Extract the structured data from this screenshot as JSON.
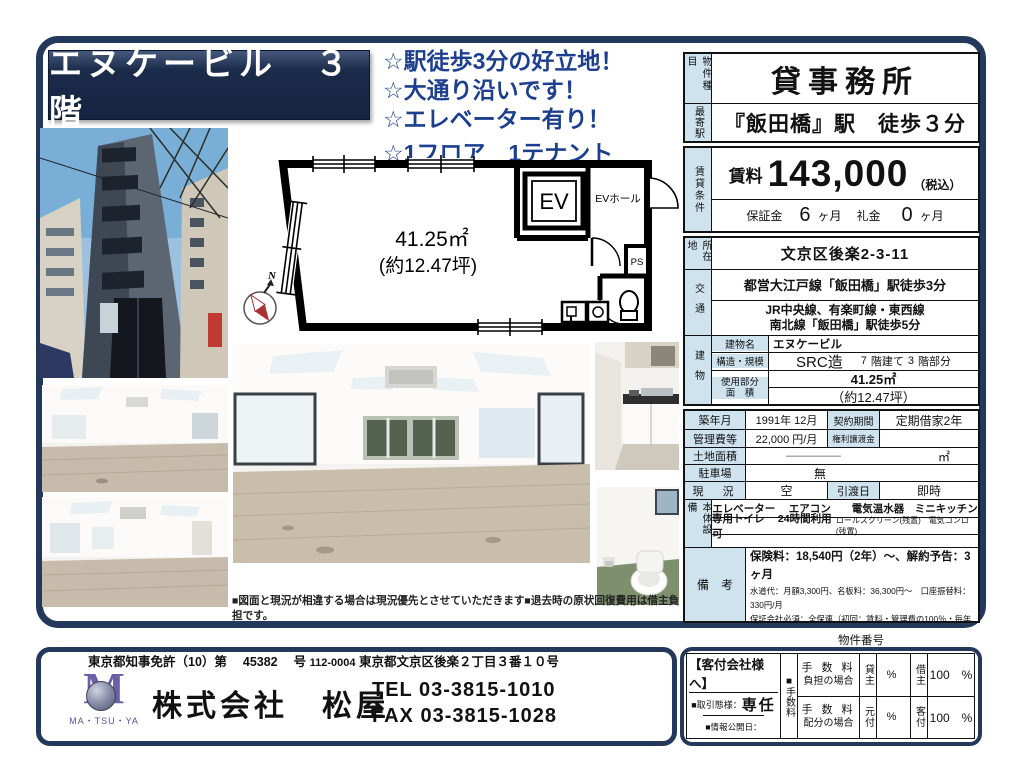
{
  "header": {
    "title": "エヌケービル　３階",
    "highlights": [
      "☆駅徒歩3分の好立地！",
      "☆大通り沿いです！",
      "☆エレベーター有り！",
      "☆1フロア　1テナント"
    ]
  },
  "floorplan": {
    "area": "41.25㎡",
    "tsubo": "(約12.47坪)",
    "ev": "EV",
    "ev_hall": "EVホール",
    "ps": "PS",
    "north": "N"
  },
  "spec": {
    "type_h": "物件種目",
    "type": "貸事務所",
    "station_h": "最寄駅",
    "station": "『飯田橋』駅　徒歩３分",
    "terms_h": "賃貸条件",
    "rent_label": "賃料",
    "rent": "143,000",
    "tax": "（税込）",
    "deposit_label": "保証金",
    "deposit": "6",
    "deposit_unit": "ヶ月",
    "key_label": "礼金",
    "key": "0",
    "key_unit": "ヶ月",
    "address_h": "所在地",
    "address": "文京区後楽2-3-11",
    "access_h": "交通",
    "access1": "都営大江戸線「飯田橋」駅徒歩3分",
    "access2a": "JR中央線、有楽町線・東西線",
    "access2b": "南北線「飯田橋」駅徒歩5分",
    "building_h": "建物",
    "bname_label": "建物名",
    "bname": "エヌケービル",
    "structure_label": "構造・規模",
    "structure": "SRC造",
    "floors": "7",
    "floors_suffix": "階建て",
    "floor_no": "3",
    "floor_suffix": "階部分",
    "area_label1": "使用部分",
    "area_label2": "面　積",
    "area": "41.25㎡",
    "area_tsubo": "（約12.47坪）",
    "built_label": "築年月",
    "built": "1991年 12月",
    "contract_label": "契約期間",
    "contract": "定期借家2年",
    "mgmt_label": "管理費等",
    "mgmt": "22,000 円/月",
    "rights_label": "権利譲渡金",
    "rights": "",
    "land_label": "土地面積",
    "land": "―――――",
    "land_unit": "㎡",
    "parking_label": "駐車場",
    "parking": "無",
    "status_label": "現　況",
    "status": "空",
    "handover_label": "引渡日",
    "handover": "即時",
    "equip_h": "本体設備",
    "equip1": "エレベーター　 エアコン　　電気温水器　ミニキッチン",
    "equip2a": "専用トイレ　 24時間利用可",
    "equip2b": "ロールスクリーン(残置)　電気コンロ(残置)",
    "equip3": "",
    "notes_h": "備　考",
    "notes": [
      "再契約料：新賃料1ヶ月分（再契約時）",
      "保険料：18,540円（2年）～、解約予告：3ヶ月",
      "水道代：月額3,300円、名板料：36,300円～　口座振替料：330円/月",
      "保証会社必須：全保連（初回：賃料・管理費の100％・毎年10％）"
    ]
  },
  "disclaimer": "■図面と現況が相違する場合は現況優先とさせていただきます■退去時の原状回復費用は借主負担です。",
  "footer": {
    "license": "東京都知事免許（10）第　 45382 　号",
    "postal": "112-0004",
    "address": "東京都文京区後楽２丁目３番１０号",
    "company": "株式会社　松屋",
    "tel": "TEL 03-3815-1010",
    "fax": "FAX 03-3815-1028",
    "logo": "MA・TSU・YA"
  },
  "agent": {
    "property_no": "物件番号",
    "to_agents": "【客付会社様へ】",
    "deal_label": "■取引態様：",
    "deal": "専任",
    "publish_label": "■情報公開日：",
    "fee_v1": "■",
    "fee_v2": "手数料",
    "burden_l1": "手 数 料",
    "burden_l2": "負担の場合",
    "split_l1": "手 数 料",
    "split_l2": "配分の場合",
    "landlord": "貸主",
    "landlord_pct": "%",
    "tenant": "借主",
    "tenant_pct": "100　%",
    "motozuke": "元付",
    "motozuke_pct": "%",
    "kyakuzuke": "客付",
    "kyakuzuke_pct": "100　%"
  },
  "colors": {
    "frame_navy": "#24385b",
    "head_blue": "#cfe3ef",
    "highlight_blue": "#1d3f8f"
  }
}
